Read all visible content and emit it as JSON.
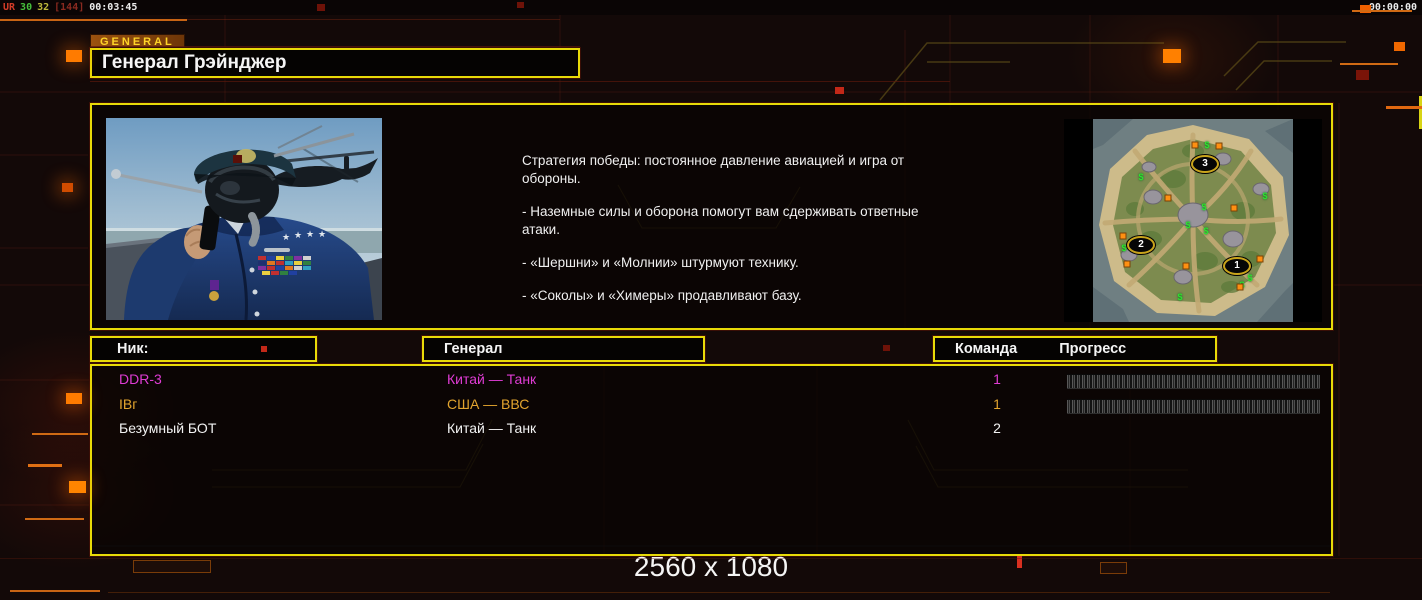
{
  "colors": {
    "accent_yellow": "#e8da08",
    "accent_orange": "#ff7b00",
    "tab_text": "#ffd428",
    "body_text": "#f0f0f0"
  },
  "overlay": {
    "segments": [
      {
        "text": "UR",
        "color": "#d43c28"
      },
      {
        "text": "30",
        "color": "#46c03c"
      },
      {
        "text": "32",
        "color": "#c0bc3c"
      },
      {
        "text": "[144]",
        "color": "#8a2a20"
      },
      {
        "text": "00:03:45",
        "color": "#ececec"
      }
    ],
    "clock": "00:00:00"
  },
  "header": {
    "tab": "GENERAL",
    "title": "Генерал Грэйнджер"
  },
  "briefing": {
    "paragraphs": [
      "Стратегия победы: постоянное давление авиацией и игра от обороны.",
      "- Наземные силы и оборона помогут вам сдерживать ответные атаки.",
      "- «Шершни» и «Молнии» штурмуют технику.",
      "- «Соколы» и «Химеры» продавливают базу."
    ]
  },
  "minimap": {
    "markers": [
      {
        "label": "3",
        "x": 141,
        "y": 45
      },
      {
        "label": "2",
        "x": 77,
        "y": 126
      },
      {
        "label": "1",
        "x": 173,
        "y": 147
      }
    ],
    "supply_symbol": "$",
    "supplies": [
      [
        143,
        26
      ],
      [
        77,
        58
      ],
      [
        201,
        77
      ],
      [
        140,
        88
      ],
      [
        124,
        106
      ],
      [
        142,
        112
      ],
      [
        60,
        129
      ],
      [
        186,
        159
      ],
      [
        178,
        166
      ],
      [
        116,
        178
      ]
    ],
    "oils": [
      [
        131,
        26
      ],
      [
        155,
        27
      ],
      [
        104,
        79
      ],
      [
        170,
        89
      ],
      [
        59,
        117
      ],
      [
        63,
        145
      ],
      [
        122,
        147
      ],
      [
        196,
        140
      ],
      [
        176,
        168
      ]
    ]
  },
  "table": {
    "headers": {
      "nick": "Ник:",
      "general": "Генерал",
      "team": "Команда",
      "progress": "Прогресс"
    },
    "players": [
      {
        "nick": "DDR-3",
        "general": "Китай — Танк",
        "team": "1",
        "color": "#df3cd4",
        "has_progress": true
      },
      {
        "nick": "IBг",
        "general": "США — ВВС",
        "team": "1",
        "color": "#e2a42e",
        "has_progress": true
      },
      {
        "nick": "Безумный БОТ",
        "general": "Китай — Танк",
        "team": "2",
        "color": "#f2f2f2",
        "has_progress": false
      }
    ]
  },
  "footer": {
    "resolution": "2560 x 1080"
  },
  "decor": {
    "squares": [
      {
        "x": 66,
        "y": 50,
        "w": 16,
        "h": 12,
        "c": "#ff7b00",
        "glow": true
      },
      {
        "x": 1163,
        "y": 49,
        "w": 18,
        "h": 14,
        "c": "#ff8000",
        "glow": true
      },
      {
        "x": 62,
        "y": 183,
        "w": 11,
        "h": 9,
        "c": "#d04c00",
        "glow": true
      },
      {
        "x": 66,
        "y": 393,
        "w": 16,
        "h": 11,
        "c": "#ff7b00",
        "glow": true
      },
      {
        "x": 69,
        "y": 481,
        "w": 17,
        "h": 12,
        "c": "#ff8400",
        "glow": true
      },
      {
        "x": 1360,
        "y": 5,
        "w": 11,
        "h": 8,
        "c": "#f06000",
        "glow": false
      },
      {
        "x": 1394,
        "y": 42,
        "w": 11,
        "h": 9,
        "c": "#f06800",
        "glow": false
      },
      {
        "x": 1356,
        "y": 70,
        "w": 13,
        "h": 10,
        "c": "#7a1408",
        "glow": false
      },
      {
        "x": 317,
        "y": 4,
        "w": 8,
        "h": 7,
        "c": "#6e1208",
        "glow": false
      },
      {
        "x": 517,
        "y": 2,
        "w": 7,
        "h": 6,
        "c": "#6e1208",
        "glow": false
      },
      {
        "x": 835,
        "y": 87,
        "w": 9,
        "h": 7,
        "c": "#c22818",
        "glow": false
      },
      {
        "x": 261,
        "y": 346,
        "w": 6,
        "h": 6,
        "c": "#c22818",
        "glow": false
      },
      {
        "x": 883,
        "y": 345,
        "w": 7,
        "h": 6,
        "c": "#6e1208",
        "glow": false
      },
      {
        "x": 233,
        "y": 155,
        "w": 9,
        "h": 8,
        "c": "#5a1008",
        "glow": false
      },
      {
        "x": 1017,
        "y": 556,
        "w": 5,
        "h": 12,
        "c": "#d83020",
        "glow": false
      }
    ],
    "lines": [
      {
        "x": 0,
        "y": 19,
        "w": 187,
        "h": 2,
        "c": "#c86414"
      },
      {
        "x": 187,
        "y": 19,
        "w": 373,
        "h": 1,
        "c": "rgba(150,50,20,0.35)"
      },
      {
        "x": 1352,
        "y": 10,
        "w": 60,
        "h": 2,
        "c": "#d06a14"
      },
      {
        "x": 1340,
        "y": 63,
        "w": 58,
        "h": 2,
        "c": "#d06a14"
      },
      {
        "x": 1386,
        "y": 106,
        "w": 36,
        "h": 3,
        "c": "#e06810"
      },
      {
        "x": 32,
        "y": 433,
        "w": 56,
        "h": 2,
        "c": "#d06a14"
      },
      {
        "x": 28,
        "y": 464,
        "w": 34,
        "h": 3,
        "c": "#e07014"
      },
      {
        "x": 25,
        "y": 518,
        "w": 59,
        "h": 2,
        "c": "#d06a14"
      },
      {
        "x": 10,
        "y": 590,
        "w": 90,
        "h": 2,
        "c": "#c86414"
      },
      {
        "x": 108,
        "y": 592,
        "w": 1222,
        "h": 1,
        "c": "rgba(110,50,10,0.55)"
      },
      {
        "x": 90,
        "y": 81,
        "w": 860,
        "h": 1,
        "c": "rgba(90,24,12,0.7)"
      },
      {
        "x": 90,
        "y": 46,
        "w": 490,
        "h": 1,
        "c": "rgba(90,24,12,0.7)"
      },
      {
        "x": 0,
        "y": 558,
        "w": 1422,
        "h": 1,
        "c": "rgba(90,24,12,0.4)"
      }
    ],
    "frames": [
      {
        "x": 133,
        "y": 560,
        "w": 76,
        "h": 11
      },
      {
        "x": 1100,
        "y": 562,
        "w": 25,
        "h": 10
      }
    ]
  }
}
